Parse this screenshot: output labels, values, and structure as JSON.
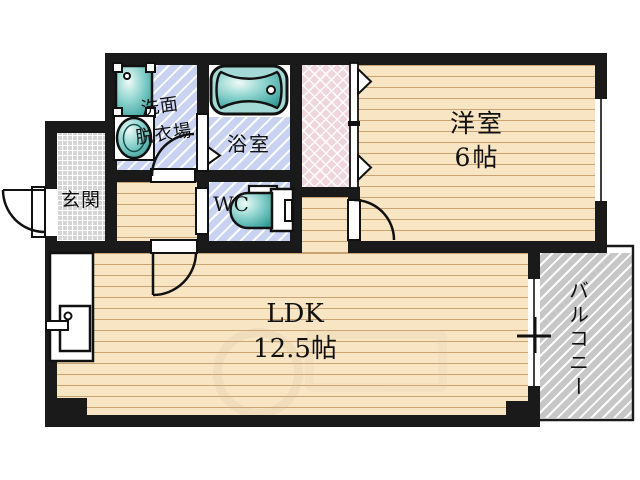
{
  "title": "apartment-floor-plan",
  "labels": {
    "western_room": {
      "name": "洋室",
      "size": "6帖"
    },
    "ldk": {
      "name": "LDK",
      "size": "12.5帖"
    },
    "bathroom": {
      "name": "浴室"
    },
    "washroom": {
      "line1": "洗面",
      "line2": "脱衣場"
    },
    "toilet": {
      "name": "WC"
    },
    "entrance": {
      "name": "玄関"
    },
    "balcony": {
      "name": "バルコニー"
    }
  },
  "icons": {
    "bathtub-icon": "rounded rectangle tub with drain circle",
    "toilet-icon": "side-view toilet with tank",
    "vanity-sink-icon": "square basin with corner mounts",
    "washing-machine-icon": "oval drum in box",
    "kitchen-sink-icon": "counter with basin, faucet dot and handle",
    "door-arc-icon": "quarter-circle swing arc",
    "sliding-door-icon": "white strip with triangle markers",
    "window-icon": "white strip with center line",
    "balcony-window-icon": "sliding window with cross latch mark"
  },
  "colors": {
    "wall": "#1a1a1a",
    "wood_floor": "#f8e5c3",
    "wood_line": "#c9a371",
    "wet_floor": "#c9d3f1",
    "closet_fill": "#efd5dc",
    "entrance_tile": "#d5d5d5",
    "balcony_fill": "#c7c7c7",
    "fixture_teal": "#47b1ac",
    "text": "#111111"
  }
}
